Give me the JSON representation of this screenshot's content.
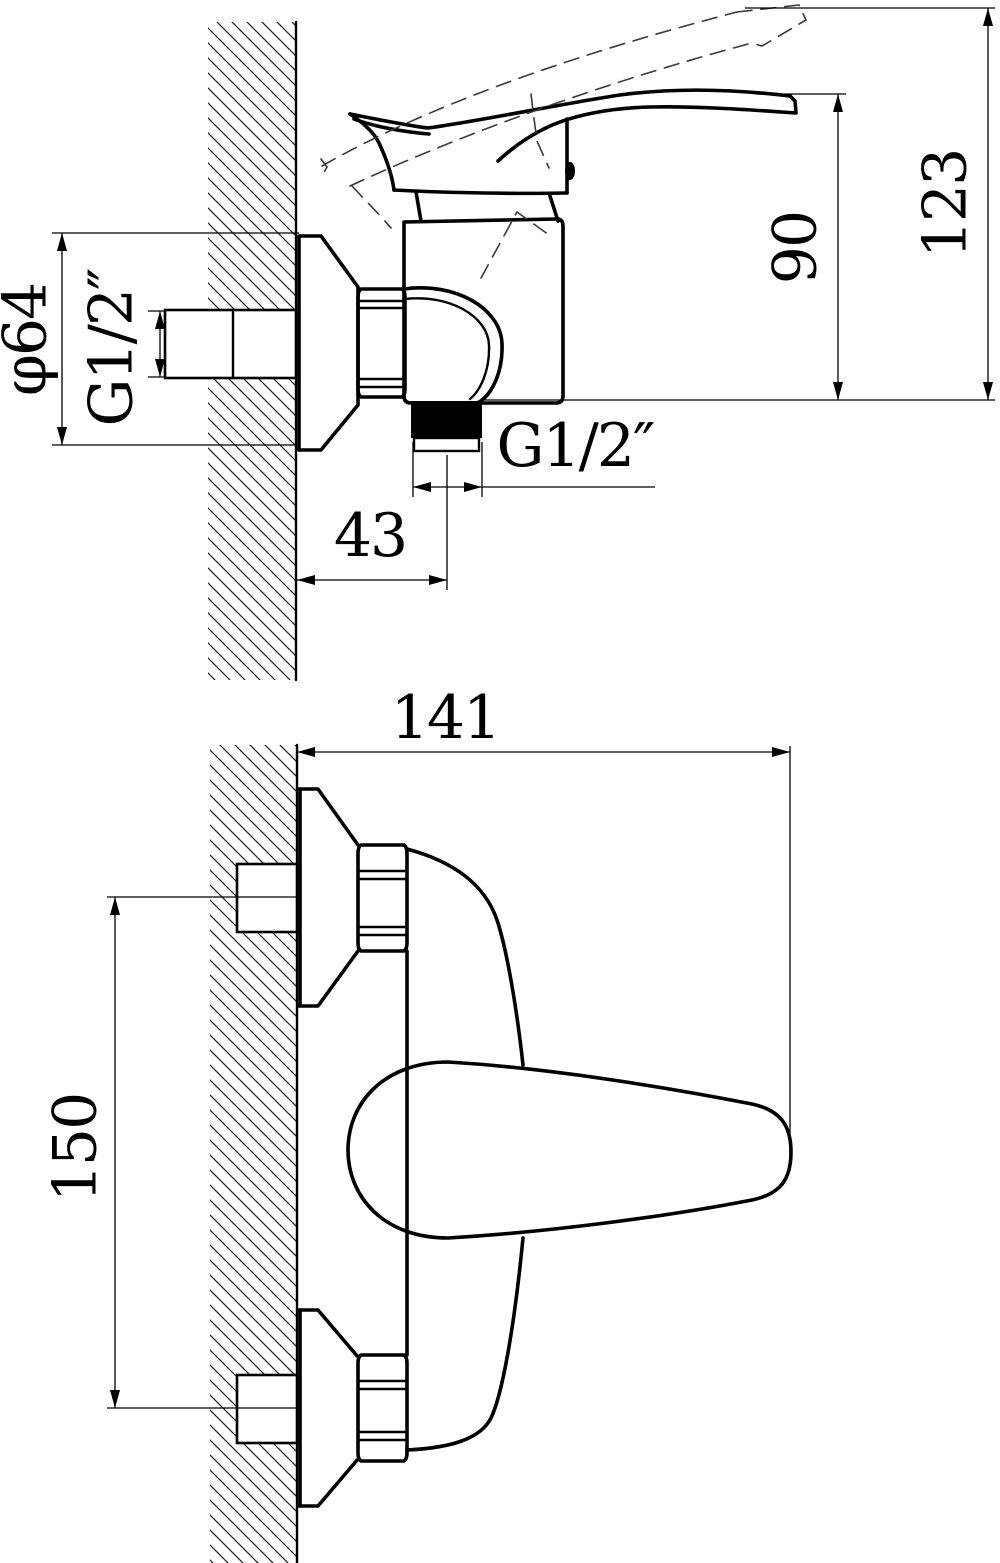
{
  "drawing": {
    "type": "technical-dimension-drawing",
    "subject": "wall-mounted single-lever shower mixer, two orthographic views",
    "background_color": "#ffffff",
    "line_color": "#000000",
    "labels": {
      "phi64": "φ64",
      "g12_wall": "G1/2″",
      "g12_outlet": "G1/2″",
      "dim43": "43",
      "dim90": "90",
      "dim123": "123",
      "dim141": "141",
      "dim150": "150"
    },
    "dimensions_mm": {
      "escutcheon_diameter": 64,
      "wall_thread": "G1/2",
      "outlet_thread": "G1/2",
      "outlet_offset_from_wall": 43,
      "handle_height_over_outlet_plane": 90,
      "max_height_handle_raised": 123,
      "projection_from_wall": 141,
      "inlet_centre_distance": 150
    }
  }
}
